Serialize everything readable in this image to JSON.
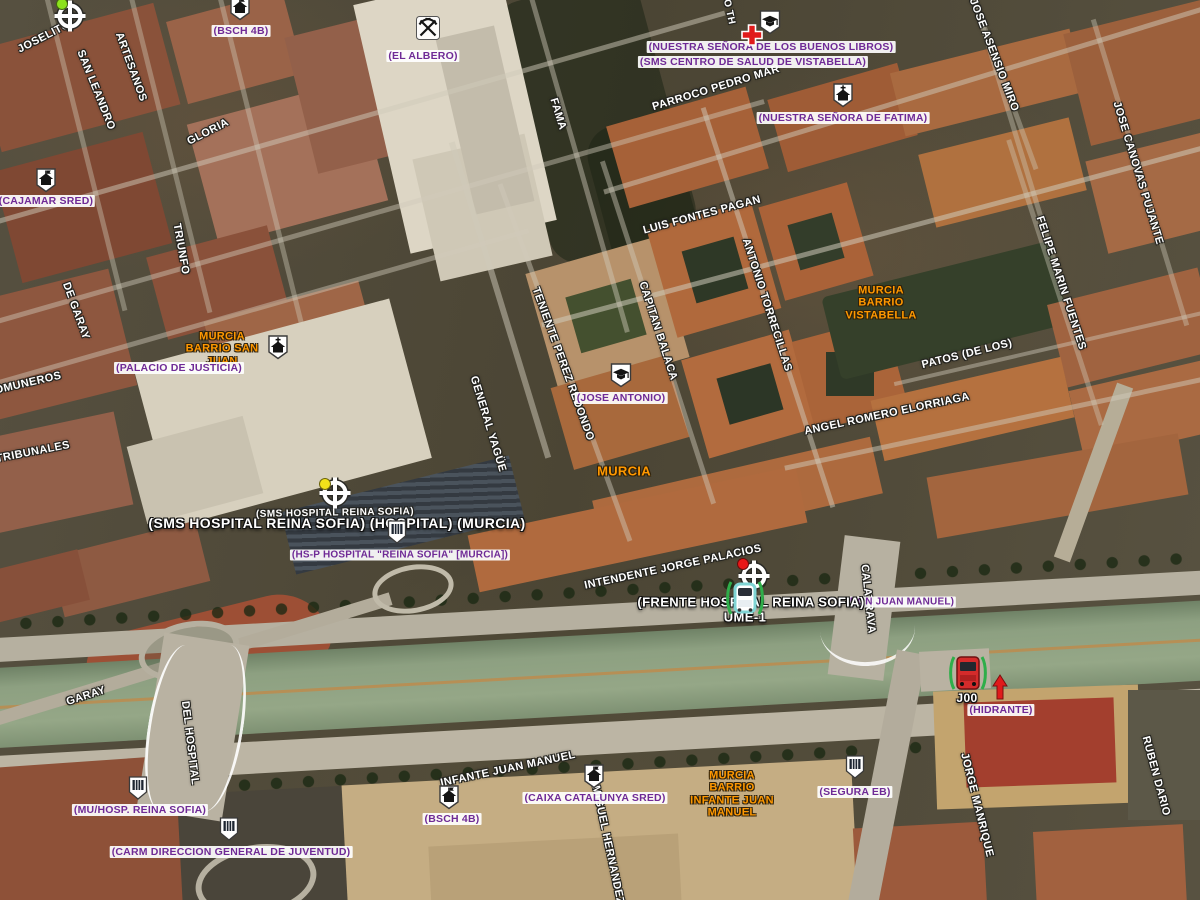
{
  "map": {
    "city": "MURCIA",
    "street_labels": [
      {
        "text": "JOSELITO",
        "x": 44,
        "y": 37,
        "rot": -27
      },
      {
        "text": "SAN LEANDRO",
        "x": 96,
        "y": 90,
        "rot": 68
      },
      {
        "text": "ARTESANOS",
        "x": 131,
        "y": 67,
        "rot": 70
      },
      {
        "text": "GLORIA",
        "x": 208,
        "y": 132,
        "rot": -27
      },
      {
        "text": "TRIUNFO",
        "x": 181,
        "y": 249,
        "rot": 80
      },
      {
        "text": "DE GARAY",
        "x": 76,
        "y": 311,
        "rot": 70
      },
      {
        "text": "COMUNEROS",
        "x": 24,
        "y": 384,
        "rot": -13
      },
      {
        "text": "TRIBUNALES",
        "x": 33,
        "y": 452,
        "rot": -11
      },
      {
        "text": "FAMA",
        "x": 558,
        "y": 114,
        "rot": 73
      },
      {
        "text": "O TH",
        "x": 729,
        "y": 12,
        "rot": 78,
        "size": 10
      },
      {
        "text": "PARROCO PEDRO MAR",
        "x": 716,
        "y": 88,
        "rot": -17
      },
      {
        "text": "LUIS FONTES PAGAN",
        "x": 702,
        "y": 215,
        "rot": -15
      },
      {
        "text": "ANTONIO TORRECILLAS",
        "x": 767,
        "y": 305,
        "rot": 72
      },
      {
        "text": "CAPITAN BALACA",
        "x": 658,
        "y": 331,
        "rot": 72
      },
      {
        "text": "TENIENTE PEREZ REDONDO",
        "x": 563,
        "y": 364,
        "rot": 70
      },
      {
        "text": "GENERAL YAGÜE",
        "x": 488,
        "y": 424,
        "rot": 73
      },
      {
        "text": "JOSE ASENSIO MIRO",
        "x": 994,
        "y": 55,
        "rot": 69
      },
      {
        "text": "JOSE CANOVAS PUJANTE",
        "x": 1138,
        "y": 173,
        "rot": 73
      },
      {
        "text": "FELIPE MARIN FUENTES",
        "x": 1061,
        "y": 283,
        "rot": 72
      },
      {
        "text": "PATOS (DE LOS)",
        "x": 967,
        "y": 354,
        "rot": -14
      },
      {
        "text": "ANGEL ROMERO ELORRIAGA",
        "x": 887,
        "y": 414,
        "rot": -12
      },
      {
        "text": "INTENDENTE JORGE PALACIOS",
        "x": 673,
        "y": 567,
        "rot": -12
      },
      {
        "text": "CALATRAVA",
        "x": 868,
        "y": 599,
        "rot": 84
      },
      {
        "text": "GARAY",
        "x": 86,
        "y": 696,
        "rot": -18
      },
      {
        "text": "DEL HOSPITAL",
        "x": 190,
        "y": 743,
        "rot": 83
      },
      {
        "text": "INFANTE JUAN MANUEL",
        "x": 508,
        "y": 769,
        "rot": -12
      },
      {
        "text": "MIGUEL HERNANDEZ",
        "x": 608,
        "y": 845,
        "rot": 78
      },
      {
        "text": "JORGE MANRIQUE",
        "x": 977,
        "y": 805,
        "rot": 76
      },
      {
        "text": "RUBEN DARIO",
        "x": 1156,
        "y": 776,
        "rot": 75
      },
      {
        "text": "(SMS HOSPITAL REINA SOFIA)",
        "x": 335,
        "y": 513,
        "rot": -1,
        "size": 10
      }
    ],
    "poi_labels": [
      {
        "text": "(BSCH 4B)",
        "x": 241,
        "y": 31
      },
      {
        "text": "(EL ALBERO)",
        "x": 423,
        "y": 56
      },
      {
        "text": "(NUESTRA SEÑORA DE LOS BUENOS LIBROS)",
        "x": 771,
        "y": 47
      },
      {
        "text": "(SMS CENTRO DE SALUD DE VISTABELLA)",
        "x": 753,
        "y": 62
      },
      {
        "text": "(NUESTRA SEÑORA DE FATIMA)",
        "x": 843,
        "y": 118
      },
      {
        "text": "(CAJAMAR SRED)",
        "x": 46,
        "y": 201
      },
      {
        "text": "(PALACIO DE JUSTICIA)",
        "x": 179,
        "y": 368
      },
      {
        "text": "(JOSE ANTONIO)",
        "x": 621,
        "y": 398
      },
      {
        "text": "(HS-P HOSPITAL \"REINA SOFIA\" [MURCIA])",
        "x": 400,
        "y": 555,
        "size": 10
      },
      {
        "text": "DON JUAN MANUEL)",
        "x": 902,
        "y": 602,
        "size": 10
      },
      {
        "text": "(MU/HOSP. REINA SOFIA)",
        "x": 140,
        "y": 810
      },
      {
        "text": "(CARM DIRECCION GENERAL DE JUVENTUD)",
        "x": 231,
        "y": 852
      },
      {
        "text": "(BSCH 4B)",
        "x": 452,
        "y": 819
      },
      {
        "text": "(CAIXA CATALUNYA SRED)",
        "x": 595,
        "y": 798
      },
      {
        "text": "(SEGURA EB)",
        "x": 855,
        "y": 792
      },
      {
        "text": "(HIDRANTE)",
        "x": 1001,
        "y": 710
      }
    ],
    "area_labels": [
      {
        "lines": [
          "MURCIA",
          "BARRIO SAN",
          "JUAN"
        ],
        "x": 222,
        "y": 349
      },
      {
        "lines": [
          "MURCIA",
          "BARRIO",
          "VISTABELLA"
        ],
        "x": 881,
        "y": 303
      },
      {
        "lines": [
          "MURCIA",
          "BARRIO",
          "INFANTE JUAN",
          "MANUEL"
        ],
        "x": 732,
        "y": 794
      },
      {
        "lines": [
          "MURCIA"
        ],
        "x": 624,
        "y": 472,
        "size": 13
      }
    ],
    "emphasis_labels": [
      {
        "text": "(SMS HOSPITAL REINA SOFIA) (HOSPITAL) (MURCIA)",
        "x": 337,
        "y": 523,
        "size": 14
      },
      {
        "text": "(FRENTE HOSPITAL REINA SOFIA)",
        "x": 751,
        "y": 602,
        "size": 13
      },
      {
        "text": "UME-1",
        "x": 745,
        "y": 617,
        "size": 13
      },
      {
        "text": "J00",
        "x": 967,
        "y": 698,
        "size": 12
      }
    ],
    "markers": [
      {
        "type": "crosshair",
        "x": 70,
        "y": 16,
        "dot": "#8ce21c",
        "ddx": -9,
        "ddy": -13
      },
      {
        "type": "house",
        "x": 240,
        "y": 8
      },
      {
        "type": "pickaxes",
        "x": 428,
        "y": 28
      },
      {
        "type": "school",
        "x": 770,
        "y": 22
      },
      {
        "type": "redcross",
        "x": 752,
        "y": 35
      },
      {
        "type": "church",
        "x": 843,
        "y": 95
      },
      {
        "type": "house",
        "x": 46,
        "y": 180
      },
      {
        "type": "church",
        "x": 278,
        "y": 347
      },
      {
        "type": "school",
        "x": 621,
        "y": 375
      },
      {
        "type": "crosshair",
        "x": 335,
        "y": 493,
        "dot": "#f2e11a",
        "ddx": -11,
        "ddy": -10
      },
      {
        "type": "shield",
        "x": 397,
        "y": 532
      },
      {
        "type": "crosshair",
        "x": 754,
        "y": 576,
        "dot": "#e81717",
        "ddx": -12,
        "ddy": -13
      },
      {
        "type": "ambulance",
        "x": 745,
        "y": 598
      },
      {
        "type": "bus",
        "x": 968,
        "y": 673
      },
      {
        "type": "arrow",
        "x": 1000,
        "y": 687
      },
      {
        "type": "shield",
        "x": 138,
        "y": 788
      },
      {
        "type": "shield",
        "x": 229,
        "y": 829
      },
      {
        "type": "shield",
        "x": 855,
        "y": 767
      },
      {
        "type": "house",
        "x": 594,
        "y": 776
      },
      {
        "type": "house",
        "x": 449,
        "y": 797
      }
    ],
    "colors": {
      "street_text": "#ffffff",
      "poi_text": "#6f2a96",
      "area_text": "#ff9800",
      "river": "#8da081",
      "marker_green": "#2fae4a",
      "cross_red": "#e01b1b"
    }
  }
}
